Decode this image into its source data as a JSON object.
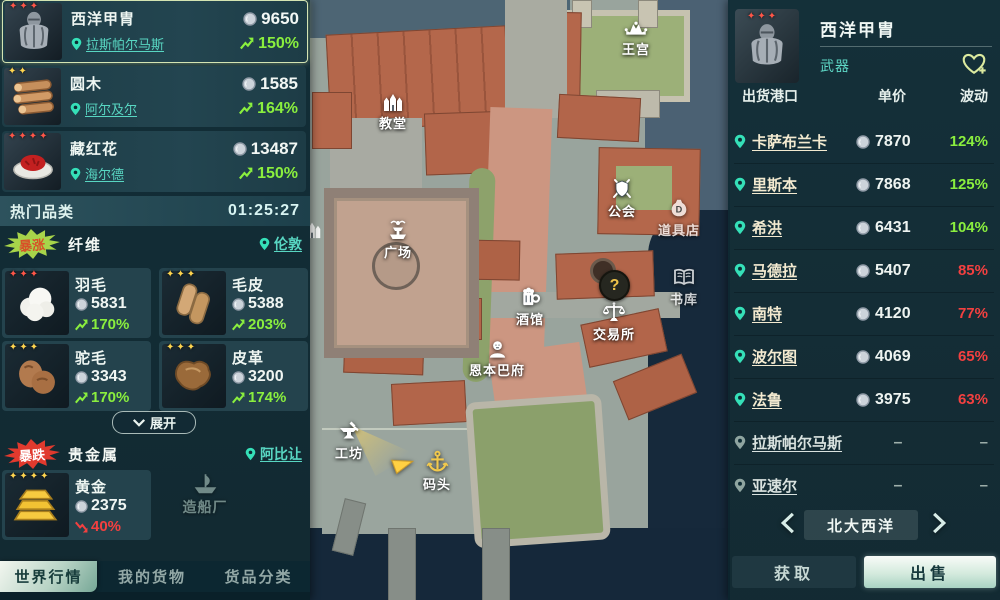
{
  "colors": {
    "up_green": "#8aef3e",
    "down_red": "#f34040",
    "teal_link": "#58d6c2",
    "gold_accent": "#f2c94c",
    "panel_teal": "#102c36"
  },
  "left_panel": {
    "featured_items": [
      {
        "stars": "✦✦✦",
        "name": "西洋甲胄",
        "location": "拉斯帕尔马斯",
        "price": "9650",
        "change": "150%"
      },
      {
        "stars": "✦✦",
        "name": "圆木",
        "location": "阿尔及尔",
        "price": "1585",
        "change": "164%"
      },
      {
        "stars": "✦✦✦✦",
        "name": "藏红花",
        "location": "海尔德",
        "price": "13487",
        "change": "150%"
      }
    ],
    "hot_section": {
      "title": "热门品类",
      "timer": "01:25:27"
    },
    "surge": {
      "badge": "暴涨",
      "category": "纤维",
      "location": "伦敦",
      "items": [
        {
          "stars": "✦✦✦",
          "name": "羽毛",
          "price": "5831",
          "change": "170%"
        },
        {
          "stars": "✦✦✦",
          "name": "毛皮",
          "price": "5388",
          "change": "203%"
        },
        {
          "stars": "✦✦✦",
          "name": "驼毛",
          "price": "3343",
          "change": "170%"
        },
        {
          "stars": "✦✦✦",
          "name": "皮革",
          "price": "3200",
          "change": "174%"
        }
      ]
    },
    "expand_label": "展开",
    "slump": {
      "badge": "暴跌",
      "category": "贵金属",
      "location": "阿比让",
      "items": [
        {
          "stars": "✦✦✦✦",
          "name": "黄金",
          "price": "2375",
          "change": "40%"
        }
      ]
    },
    "tabs": [
      {
        "label": "世界行情"
      },
      {
        "label": "我的货物"
      },
      {
        "label": "货品分类"
      }
    ]
  },
  "map": {
    "question_mark": "?",
    "pois": [
      {
        "id": "church",
        "label": "教堂"
      },
      {
        "id": "palace",
        "label": "王宫"
      },
      {
        "id": "guild",
        "label": "公会"
      },
      {
        "id": "item-shop",
        "label": "道具店"
      },
      {
        "id": "plaza",
        "label": "广场"
      },
      {
        "id": "library",
        "label": "书库"
      },
      {
        "id": "tavern",
        "label": "酒馆"
      },
      {
        "id": "exchange",
        "label": "交易所"
      },
      {
        "id": "mansion",
        "label": "恩本巴府"
      },
      {
        "id": "workshop",
        "label": "工坊"
      },
      {
        "id": "dock",
        "label": "码头"
      },
      {
        "id": "shipyard",
        "label": "造船厂"
      }
    ]
  },
  "right_panel": {
    "item": {
      "stars": "✦✦✦",
      "name": "西洋甲胄",
      "category": "武器"
    },
    "columns": {
      "port": "出货港口",
      "price": "单价",
      "fluct": "波动"
    },
    "rows": [
      {
        "port": "卡萨布兰卡",
        "price": "7870",
        "change": "124%"
      },
      {
        "port": "里斯本",
        "price": "7868",
        "change": "125%"
      },
      {
        "port": "希洪",
        "price": "6431",
        "change": "104%"
      },
      {
        "port": "马德拉",
        "price": "5407",
        "change": "85%"
      },
      {
        "port": "南特",
        "price": "4120",
        "change": "77%"
      },
      {
        "port": "波尔图",
        "price": "4069",
        "change": "65%"
      },
      {
        "port": "法鲁",
        "price": "3975",
        "change": "63%"
      },
      {
        "port": "拉斯帕尔马斯",
        "price": "–",
        "change": "–"
      },
      {
        "port": "亚速尔",
        "price": "–",
        "change": "–"
      }
    ],
    "region": "北大西洋",
    "acquire_label": "获取",
    "sell_label": "出售"
  }
}
